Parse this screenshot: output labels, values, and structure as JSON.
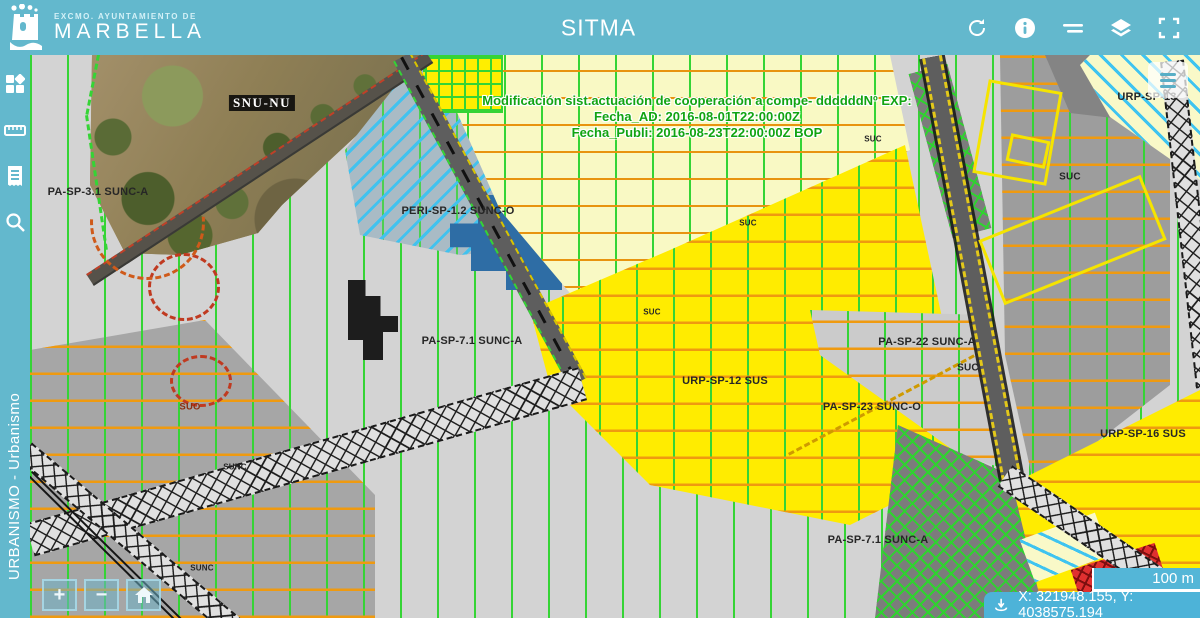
{
  "header": {
    "org_line1": "EXCMO. AYUNTAMIENTO DE",
    "org_line2": "MARBELLA",
    "title": "SITMA",
    "action_icons": [
      "refresh",
      "info",
      "swipe-compare",
      "layers",
      "fullscreen"
    ]
  },
  "sidebar": {
    "tool_icons": [
      "apps-grid",
      "measure-ruler",
      "legend-list",
      "search"
    ],
    "vertical_label": "URBANISMO - Urbanismo"
  },
  "map": {
    "annotation": {
      "line1": "Modificación sist.actuación de cooperación a compe- ddddddNº EXP:",
      "line2": "Fecha_AD: 2016-08-01T22:00:00Z",
      "line3": "Fecha_Publi: 2016-08-23T22:00:00Z BOP"
    },
    "labels": [
      {
        "text": "SNU-NU",
        "x": 232,
        "y": 48,
        "kind": "photo-lbl"
      },
      {
        "text": "PA-SP-3.1 SUNC-A",
        "x": 68,
        "y": 137,
        "kind": "zone"
      },
      {
        "text": "PERI-SP-1.2 SUNC-O",
        "x": 428,
        "y": 156,
        "kind": "zone"
      },
      {
        "text": "PA-SP-7.1 SUNC-A",
        "x": 442,
        "y": 286,
        "kind": "zone"
      },
      {
        "text": "URP-SP-12 SUS",
        "x": 695,
        "y": 326,
        "kind": "zone"
      },
      {
        "text": "PA-SP-22 SUNC-A",
        "x": 897,
        "y": 287,
        "kind": "zone"
      },
      {
        "text": "PA-SP-23 SUNC-O",
        "x": 842,
        "y": 352,
        "kind": "zone"
      },
      {
        "text": "URP-SP-16 SUS",
        "x": 1113,
        "y": 379,
        "kind": "zone"
      },
      {
        "text": "URP-SP-13",
        "x": 1117,
        "y": 42,
        "kind": "zone"
      },
      {
        "text": "PA-SP-7.1 SUNC-A",
        "x": 848,
        "y": 485,
        "kind": "zone"
      },
      {
        "text": "SUC",
        "x": 1040,
        "y": 122,
        "kind": "zone-sm"
      },
      {
        "text": "SUC",
        "x": 938,
        "y": 313,
        "kind": "zone-sm"
      },
      {
        "text": "SUC",
        "x": 843,
        "y": 84,
        "kind": "tiny"
      },
      {
        "text": "SUC",
        "x": 718,
        "y": 168,
        "kind": "tiny"
      },
      {
        "text": "SUC",
        "x": 622,
        "y": 257,
        "kind": "tiny"
      },
      {
        "text": "SUO",
        "x": 160,
        "y": 352,
        "kind": "suo"
      },
      {
        "text": "SUNC",
        "x": 205,
        "y": 412,
        "kind": "tiny"
      },
      {
        "text": "SUNC",
        "x": 172,
        "y": 513,
        "kind": "tiny"
      }
    ],
    "controls": {
      "zoom_in": "+",
      "zoom_out": "−"
    },
    "scale_label": "100 m",
    "coordinates": "X: 321948.155, Y: 4038575.194"
  },
  "colors": {
    "header_teal": "#63b8cd",
    "bar_teal": "#4db3d8",
    "zone_yellow": "#ffec00",
    "zone_cream": "#f9f9c4",
    "hatch_green": "#35d435",
    "hatch_orange": "#ef9a10",
    "hatch_cyan": "#41c2ee",
    "annotation_green": "#12a412"
  }
}
